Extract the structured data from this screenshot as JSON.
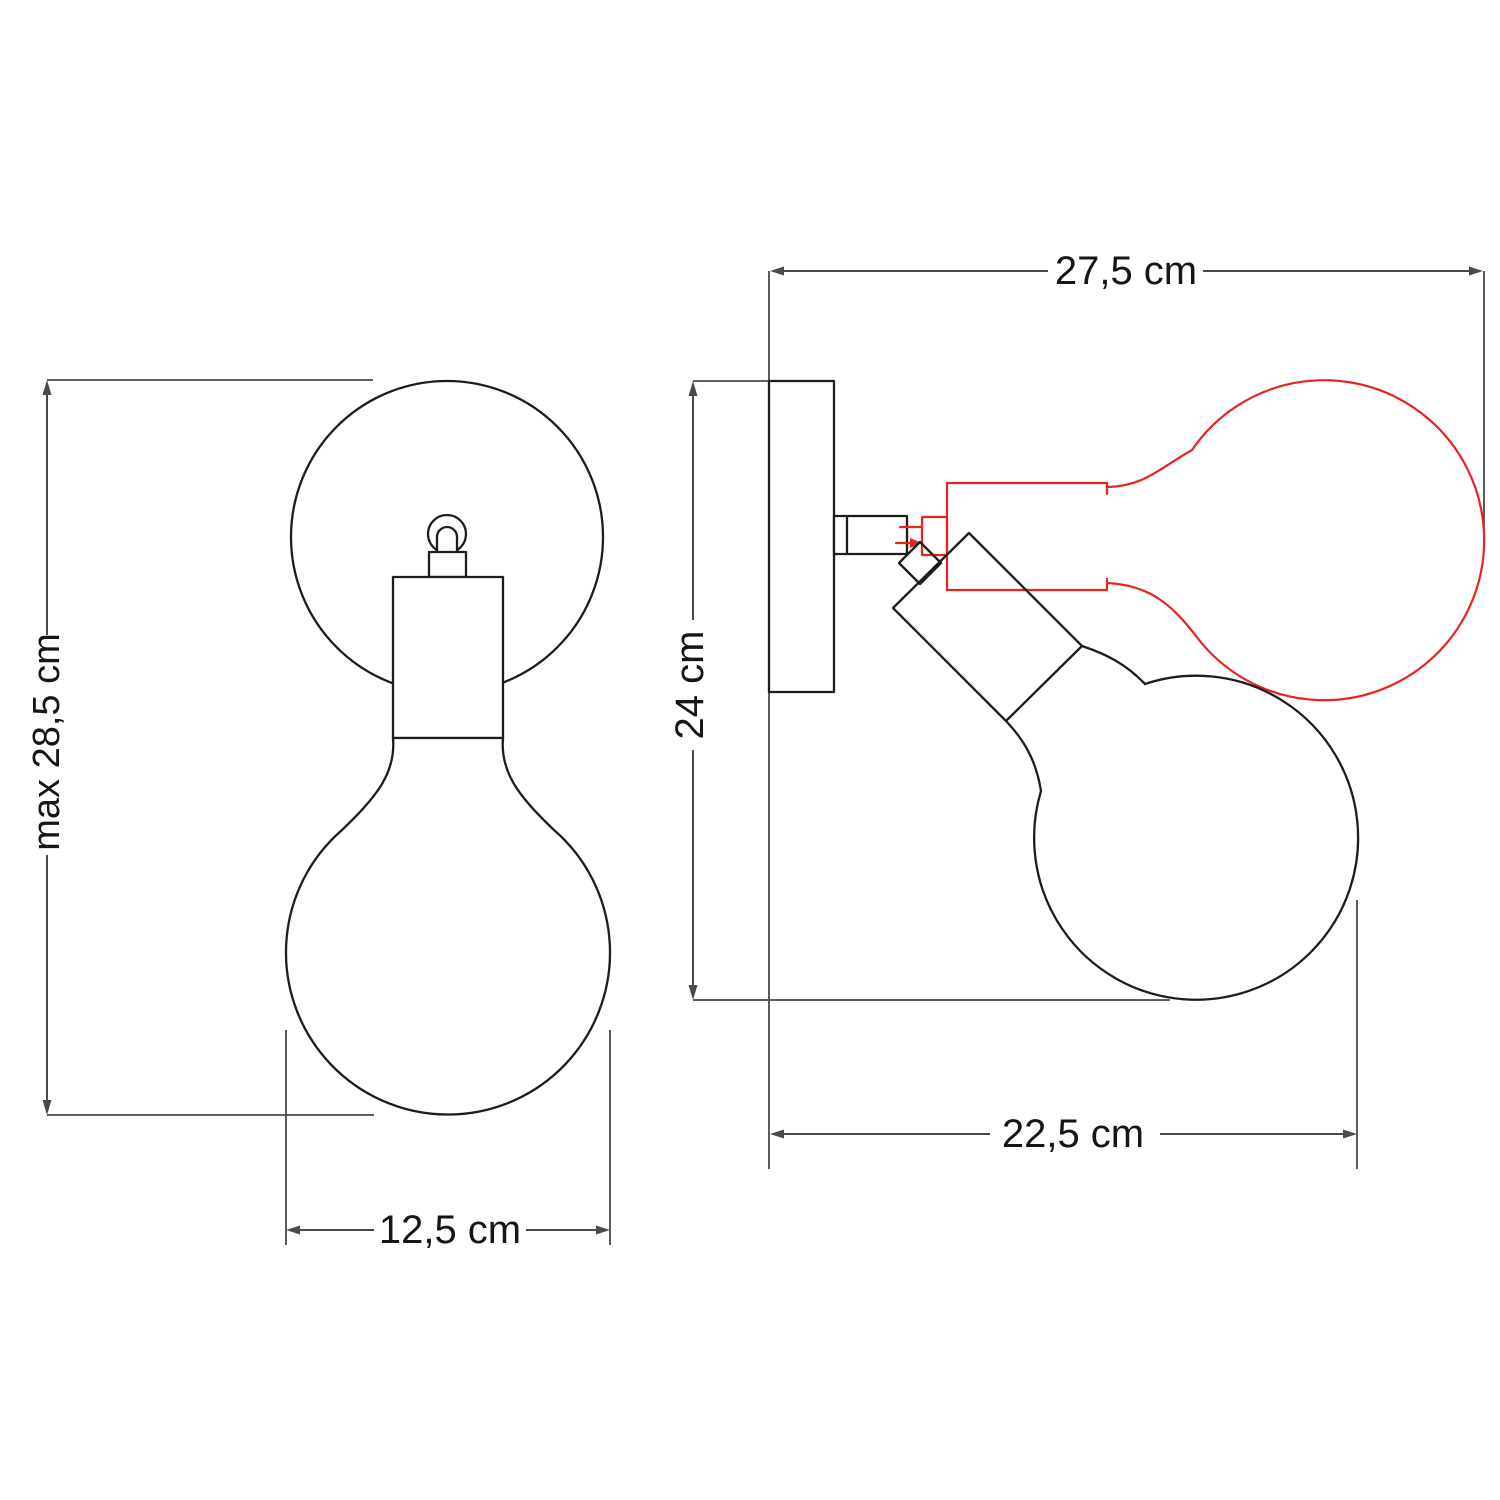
{
  "diagram": {
    "kind": "technical dimension drawing",
    "subject": "adjustable wall lamp with globe light bulb, front and side views",
    "units": "cm",
    "colors": {
      "dimension_lines": "#4a4a4a",
      "drawing_outline": "#1d1d1d",
      "alternate_position": "#e8241f",
      "background": "#ffffff"
    },
    "front_view": {
      "name": "front view",
      "dimensions": [
        {
          "id": "max_height",
          "label": "max 28,5 cm",
          "value": 28.5,
          "unit": "cm",
          "orientation": "vertical"
        },
        {
          "id": "bulb_diameter",
          "label": "12,5 cm",
          "value": 12.5,
          "unit": "cm",
          "orientation": "horizontal"
        }
      ]
    },
    "side_view": {
      "name": "side view",
      "dimensions": [
        {
          "id": "max_projection_horizontal_bulb",
          "label": "27,5 cm",
          "value": 27.5,
          "unit": "cm",
          "orientation": "horizontal"
        },
        {
          "id": "wall_plate_to_bulb_bottom",
          "label": "24 cm",
          "value": 24,
          "unit": "cm",
          "orientation": "vertical"
        },
        {
          "id": "projection_tilted_bulb",
          "label": "22,5 cm",
          "value": 22.5,
          "unit": "cm",
          "orientation": "horizontal"
        }
      ],
      "red_outline_meaning": "bulb and socket rotated to horizontal position",
      "black_outline_meaning": "bulb and socket tilted downward"
    }
  }
}
